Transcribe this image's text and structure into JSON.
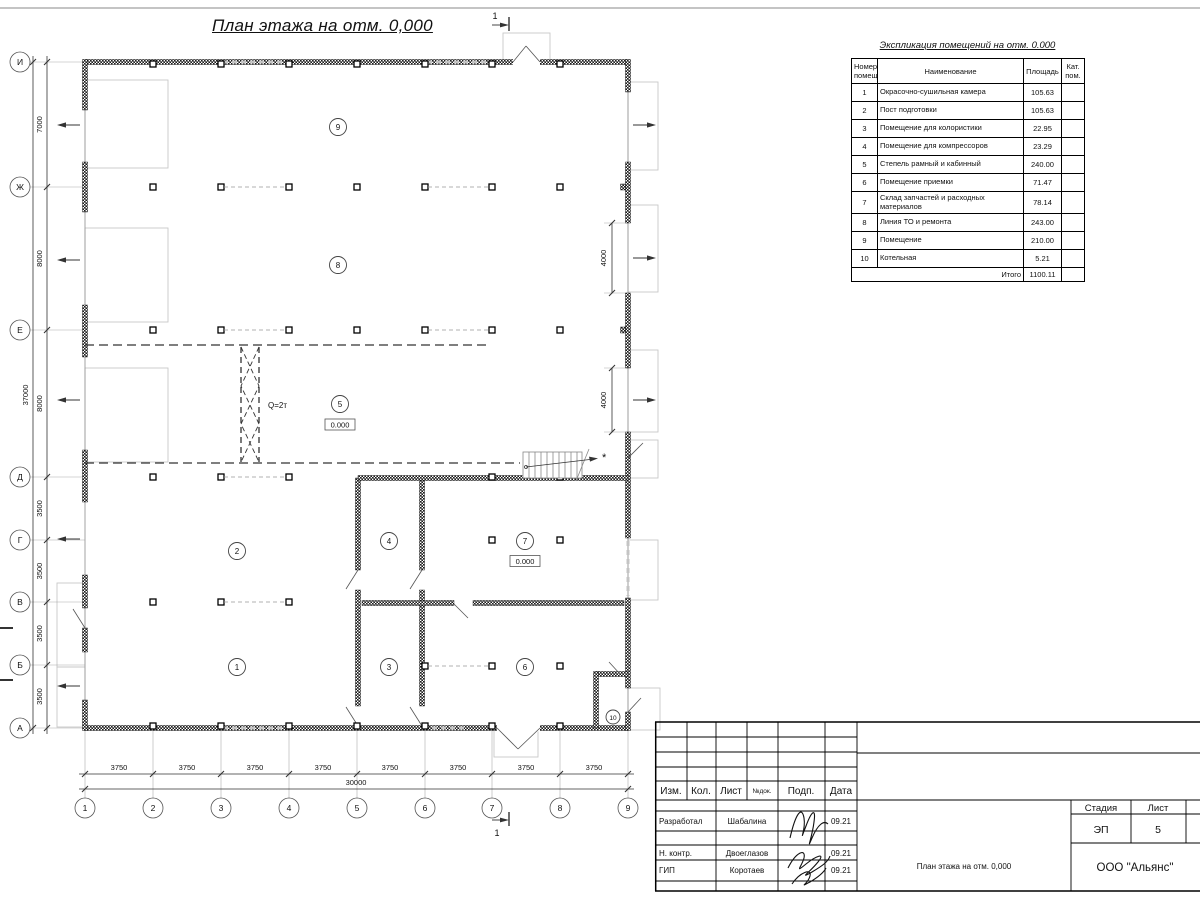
{
  "plan": {
    "title": "План этажа на отм. 0,000",
    "axes_rows": [
      "И",
      "Ж",
      "Е",
      "Д",
      "Г",
      "В",
      "Б",
      "А"
    ],
    "axes_cols": [
      "1",
      "2",
      "3",
      "4",
      "5",
      "6",
      "7",
      "8",
      "9"
    ],
    "dims_left": [
      "7000",
      "8000",
      "8000",
      "3500",
      "3500",
      "3500",
      "3500"
    ],
    "dim_left_total": "37000",
    "dims_bottom": [
      "3750",
      "3750",
      "3750",
      "3750",
      "3750",
      "3750",
      "3750",
      "3750"
    ],
    "dim_bottom_total": "30000",
    "dims_right": [
      "4000",
      "4000"
    ],
    "crane_label": "Q=2т",
    "level_mark": "0.000",
    "section_mark": "1",
    "note_star": "*",
    "rooms": [
      "1",
      "2",
      "3",
      "4",
      "5",
      "6",
      "7",
      "8",
      "9",
      "10"
    ]
  },
  "explication": {
    "title": "Экспликация помещений на отм. 0.000",
    "headers": {
      "num": "Номер помещ.",
      "name": "Наименование",
      "area": "Площадь",
      "cat": "Кат. пом."
    },
    "rows": [
      {
        "num": "1",
        "name": "Окрасочно-сушильная камера",
        "area": "105.63"
      },
      {
        "num": "2",
        "name": "Пост подготовки",
        "area": "105.63"
      },
      {
        "num": "3",
        "name": "Помещение для колористики",
        "area": "22.95"
      },
      {
        "num": "4",
        "name": "Помещение для компрессоров",
        "area": "23.29"
      },
      {
        "num": "5",
        "name": "Степель рамный и кабинный",
        "area": "240.00"
      },
      {
        "num": "6",
        "name": "Помещение приемки",
        "area": "71.47"
      },
      {
        "num": "7",
        "name": "Склад запчастей и расходных материалов",
        "area": "78.14"
      },
      {
        "num": "8",
        "name": "Линия ТО и ремонта",
        "area": "243.00"
      },
      {
        "num": "9",
        "name": "Помещение",
        "area": "210.00"
      },
      {
        "num": "10",
        "name": "Котельная",
        "area": "5.21"
      }
    ],
    "total_label": "Итого",
    "total_value": "1100.11"
  },
  "titleblock": {
    "cols": {
      "izm": "Изм.",
      "kol": "Кол.",
      "list": "Лист",
      "ndok": "№док.",
      "podp": "Подп.",
      "date": "Дата"
    },
    "sign_rows": [
      {
        "role": "Разработал",
        "name": "Шабалина",
        "date": "09.21"
      },
      {
        "role": "Н. контр.",
        "name": "Двоеглазов",
        "date": "09.21"
      },
      {
        "role": "ГИП",
        "name": "Коротаев",
        "date": "09.21"
      }
    ],
    "stage_label": "Стадия",
    "stage_value": "ЭП",
    "sheet_label": "Лист",
    "sheet_value": "5",
    "sheets_label": "Листов",
    "doc_name": "План этажа на отм. 0,000",
    "company": "ООО \"Альянс\""
  },
  "colors": {
    "ink": "#111111",
    "wall": "#1a1a1a",
    "muted": "#999999",
    "faint": "#bbbbbb"
  }
}
